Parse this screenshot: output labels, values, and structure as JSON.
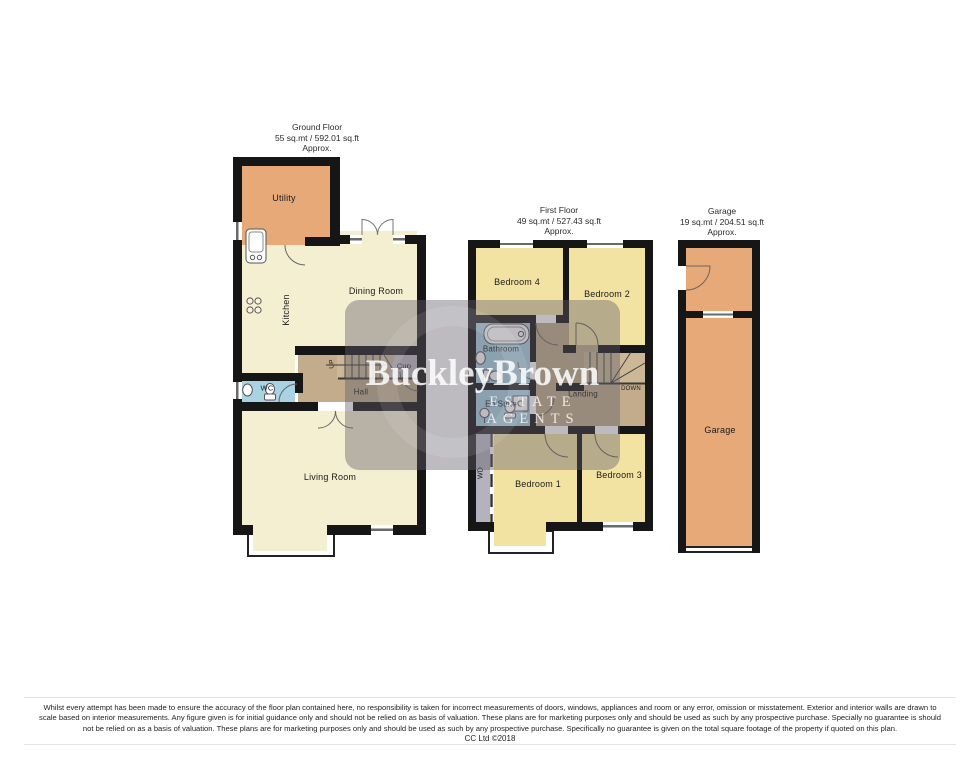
{
  "ground_floor": {
    "title": "Ground Floor",
    "area": "55 sq.mt / 592.01 sq.ft",
    "approx": "Approx.",
    "rooms": {
      "utility": "Utility",
      "kitchen": "Kitchen",
      "dining_room": "Dining Room",
      "wc": "WC",
      "cupboard": "Cup",
      "stairs_up": "UP",
      "hall": "Hall",
      "living_room": "Living Room"
    }
  },
  "first_floor": {
    "title": "First Floor",
    "area": "49 sq.mt / 527.43 sq.ft",
    "approx": "Approx.",
    "rooms": {
      "bedroom_4": "Bedroom 4",
      "bedroom_2": "Bedroom 2",
      "bathroom": "Bathroom",
      "en_suite": "En Suite",
      "landing": "Landing",
      "stairs_down": "DOWN",
      "wardrobe": "WD",
      "bedroom_1": "Bedroom 1",
      "bedroom_3": "Bedroom 3"
    }
  },
  "garage_plan": {
    "title": "Garage",
    "area": "19 sq.mt / 204.51 sq.ft",
    "approx": "Approx.",
    "rooms": {
      "garage": "Garage"
    }
  },
  "watermark": {
    "brand": "BuckleyBrown",
    "tagline": "ESTATE AGENTS"
  },
  "disclaimer": {
    "lines": [
      "Whilst every attempt has been made to ensure the accuracy of the floor plan contained here, no responsibility is taken for incorrect measurements of doors, windows, appliances and room or any error, omission or misstatement. Exterior and interior walls are drawn to",
      "scale based on interior measurements. Any figure given is for initial guidance only and should not be relied on as basis of valuation. These plans are for marketing purposes only and should be used as such by any prospective purchase. Specially no guarantee is should",
      "not be relied on as a basis of valuation. These plans are for marketing purposes only and should be used as such by any prospective purchase. Specifically no guarantee is given on the total square footage of the property if quoted on this plan."
    ],
    "copyright": "CC Ltd ©2018"
  },
  "colors": {
    "wall": "#161616",
    "room_cream": "#f5efd1",
    "room_yellow": "#f3e3a2",
    "room_orange": "#e7a977",
    "room_tan": "#c2ac8b",
    "room_stairs": "#ccb897",
    "room_blue": "#a9d2e2",
    "room_cup_gray": "#c2bbc4",
    "room_wd_gray": "#b4b2bd",
    "watermark_overlay": "rgba(98,92,104,0.42)"
  }
}
